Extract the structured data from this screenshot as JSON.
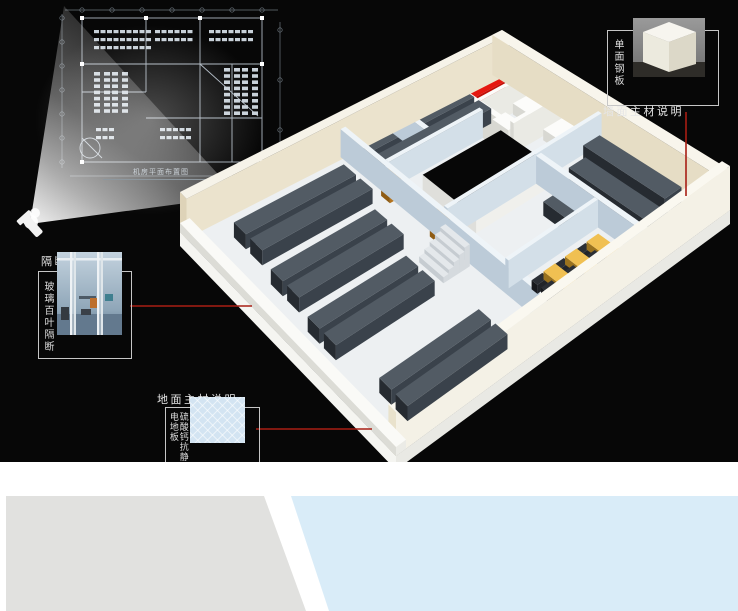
{
  "blueprint": {
    "caption": "机房平面布置图",
    "clusters": [
      {
        "x": 84,
        "y": 30,
        "cols": 9,
        "rows": 3,
        "w": 5,
        "h": 3.2,
        "gx": 1.5,
        "gy": 4.8
      },
      {
        "x": 145,
        "y": 30,
        "cols": 6,
        "rows": 2,
        "w": 5,
        "h": 3.2,
        "gx": 1.5,
        "gy": 4.8
      },
      {
        "x": 199,
        "y": 30,
        "cols": 7,
        "rows": 2,
        "w": 5,
        "h": 3.2,
        "gx": 1.5,
        "gy": 4.8
      },
      {
        "x": 84,
        "y": 72,
        "cols": 2,
        "rows": 7,
        "w": 6,
        "h": 3.6,
        "gx": 4,
        "gy": 2.6
      },
      {
        "x": 102,
        "y": 72,
        "cols": 2,
        "rows": 7,
        "w": 6,
        "h": 3.6,
        "gx": 4,
        "gy": 2.6
      },
      {
        "x": 214,
        "y": 68,
        "cols": 2,
        "rows": 8,
        "w": 6,
        "h": 3.6,
        "gx": 4,
        "gy": 2.6
      },
      {
        "x": 232,
        "y": 68,
        "cols": 2,
        "rows": 8,
        "w": 6,
        "h": 3.6,
        "gx": 4,
        "gy": 2.6
      },
      {
        "x": 150,
        "y": 128,
        "cols": 5,
        "rows": 2,
        "w": 5,
        "h": 3.2,
        "gx": 1.5,
        "gy": 4.8
      },
      {
        "x": 86,
        "y": 128,
        "cols": 3,
        "rows": 2,
        "w": 5,
        "h": 3.2,
        "gx": 1.5,
        "gy": 4.8
      }
    ]
  },
  "callouts": {
    "wall": {
      "title": "墙面主材说明",
      "material": "单面钢板"
    },
    "partition": {
      "title": "隔断主材说明",
      "material": "玻璃百叶隔断"
    },
    "floor": {
      "title": "地面主材说明",
      "material": "硫酸钙抗静电地板"
    }
  },
  "colors": {
    "canvas_bg": "#070707",
    "page_bg": "#ffffff",
    "callout_line": "#a81e14",
    "callout_border": "#c6c6c6",
    "blueprint_line": "#aeb8c2",
    "blueprint_dim": "#6b747c",
    "shape_gray": "#e1e1df",
    "shape_blue": "#d9ecf8"
  },
  "scene": {
    "corners": {
      "N": [
        502,
        70
      ],
      "E": [
        730,
        210
      ],
      "S": [
        396,
        456
      ],
      "W": [
        180,
        232
      ]
    },
    "slab": {
      "drop": 14,
      "side_se": "#e9e9e4",
      "side_sw": "#f5f5f1",
      "floor": "#edf0f2"
    },
    "palette": {
      "cream": [
        "#f6f3e9",
        "#ded3b8",
        "#ebe3cd"
      ],
      "cream2": [
        "#f8f5ec",
        "#e6ddc5",
        "#f0ead8"
      ],
      "creamBright": [
        "#faf8f0",
        "#e9e2cc",
        "#f4f1e6"
      ],
      "lip": [
        "#fafaf7",
        "#dcdcd6",
        "#ebebe6"
      ],
      "white": [
        "#fcfcfa",
        "#d8d8d2",
        "#eaeae4"
      ],
      "glass": [
        "#eef4f8",
        "#bccbd8",
        "#d3dfe8"
      ],
      "rack": [
        "#525b64",
        "#262b31",
        "#3a424b"
      ],
      "red": [
        "#e51810",
        "#8e0a06",
        "#c01008"
      ],
      "orange": [
        "#d28a30",
        "#8f5c14",
        "#b4741f"
      ],
      "yellow": [
        "#f0c052",
        "#9a721e",
        "#cf9f30"
      ],
      "dark": [
        "#2b2f35",
        "#17191d",
        "#212429"
      ],
      "holerim": [
        "#070707",
        "#dfdfdb",
        "#f0f0ec"
      ],
      "step": [
        "#e4e8eb",
        "#c6ccd1",
        "#d5dade"
      ]
    },
    "boxes": [
      [
        "outer-wall-nw",
        0,
        0,
        0.03,
        1,
        40,
        "cream"
      ],
      [
        "outer-wall-ne",
        0,
        0,
        1,
        0.03,
        40,
        "cream2"
      ],
      [
        "outer-wall-se",
        0.965,
        0,
        1,
        1,
        44,
        "creamBright"
      ],
      [
        "slab-lip-sw",
        0,
        0.97,
        1,
        1,
        9,
        "lip"
      ],
      [
        "partition-top-rooms-front",
        0,
        0.195,
        0.325,
        0.21,
        30,
        "white"
      ],
      [
        "partition-red-room-right",
        0.17,
        0.03,
        0.185,
        0.195,
        30,
        "white"
      ],
      [
        "partition-equip-room-right",
        0.315,
        0.03,
        0.33,
        0.195,
        30,
        "white"
      ],
      [
        "glass-wall-right-hall",
        0.465,
        0.03,
        0.48,
        0.5,
        30,
        "glass"
      ],
      [
        "glass-wall-right-hall-front",
        0.48,
        0.215,
        0.97,
        0.23,
        28,
        "glass"
      ],
      [
        "glass-wall-mid",
        0.02,
        0.5,
        0.97,
        0.515,
        28,
        "glass"
      ],
      [
        "glass-wall-conference",
        0.74,
        0.23,
        0.755,
        0.5,
        28,
        "glass"
      ],
      [
        "glass-wall-office",
        0.2,
        0.21,
        0.215,
        0.5,
        28,
        "glass"
      ],
      [
        "glass-wall-office-div",
        0.03,
        0.345,
        0.2,
        0.36,
        28,
        "glass"
      ],
      [
        "atrium-void",
        0.28,
        0.2,
        0.52,
        0.44,
        16,
        "holerim"
      ],
      [
        "red-equipment-row-1",
        0.06,
        0.06,
        0.1,
        0.18,
        13,
        "red"
      ],
      [
        "red-equipment-row-2",
        0.125,
        0.06,
        0.165,
        0.18,
        13,
        "red"
      ],
      [
        "ups-unit-1",
        0.19,
        0.035,
        0.3,
        0.1,
        11,
        "white"
      ],
      [
        "ups-unit-2",
        0.2,
        0.13,
        0.27,
        0.17,
        9,
        "white"
      ],
      [
        "storage-shelf",
        0.345,
        0.04,
        0.43,
        0.115,
        11,
        "white"
      ],
      [
        "stair-step-1",
        0.5,
        0.52,
        0.61,
        0.536,
        22,
        "step"
      ],
      [
        "stair-step-2",
        0.5,
        0.536,
        0.61,
        0.552,
        18,
        "step"
      ],
      [
        "stair-step-3",
        0.5,
        0.552,
        0.61,
        0.568,
        14,
        "step"
      ],
      [
        "stair-step-4",
        0.5,
        0.568,
        0.61,
        0.584,
        10,
        "step"
      ],
      [
        "stair-step-5",
        0.5,
        0.584,
        0.61,
        0.6,
        6,
        "step"
      ],
      [
        "rack-row-l1",
        0.05,
        0.16,
        0.105,
        0.48,
        15,
        "rack"
      ],
      [
        "rack-row-l2",
        0.125,
        0.16,
        0.18,
        0.48,
        15,
        "rack"
      ],
      [
        "rack-row-l3",
        0.1,
        0.56,
        0.155,
        0.9,
        15,
        "rack"
      ],
      [
        "rack-row-l4",
        0.175,
        0.56,
        0.23,
        0.9,
        15,
        "rack"
      ],
      [
        "rack-row-l5",
        0.3,
        0.6,
        0.355,
        0.92,
        15,
        "rack"
      ],
      [
        "rack-row-l6",
        0.375,
        0.6,
        0.43,
        0.92,
        15,
        "rack"
      ],
      [
        "rack-row-l7",
        0.5,
        0.64,
        0.555,
        0.94,
        15,
        "rack"
      ],
      [
        "rack-row-l8",
        0.575,
        0.64,
        0.63,
        0.94,
        15,
        "rack"
      ],
      [
        "rack-row-l9",
        0.8,
        0.62,
        0.855,
        0.92,
        15,
        "rack"
      ],
      [
        "rack-row-l10",
        0.875,
        0.62,
        0.93,
        0.92,
        15,
        "rack"
      ],
      [
        "rack-row-r1",
        0.5,
        0.05,
        0.86,
        0.1,
        15,
        "rack"
      ],
      [
        "rack-row-r2",
        0.545,
        0.125,
        0.915,
        0.175,
        15,
        "rack"
      ],
      [
        "rack-row-r3",
        0.6,
        0.245,
        0.73,
        0.29,
        14,
        "rack"
      ],
      [
        "door-orange-1",
        0.22,
        0.492,
        0.26,
        0.527,
        24,
        "orange"
      ],
      [
        "door-orange-2",
        0.44,
        0.492,
        0.48,
        0.527,
        24,
        "orange"
      ],
      [
        "conference-desk-1",
        0.8,
        0.26,
        0.97,
        0.295,
        8,
        "yellow"
      ],
      [
        "conference-desk-2",
        0.8,
        0.325,
        0.97,
        0.36,
        8,
        "yellow"
      ],
      [
        "conference-desk-3",
        0.8,
        0.39,
        0.97,
        0.425,
        8,
        "yellow"
      ]
    ],
    "chair_rows": [
      0.302,
      0.367,
      0.432
    ],
    "lines": [
      {
        "x1": 686,
        "y1": 112,
        "x2": 686,
        "y2": 196
      },
      {
        "x1": 130,
        "y1": 306,
        "x2": 252,
        "y2": 306
      },
      {
        "x1": 256,
        "y1": 429,
        "x2": 372,
        "y2": 429
      }
    ]
  }
}
